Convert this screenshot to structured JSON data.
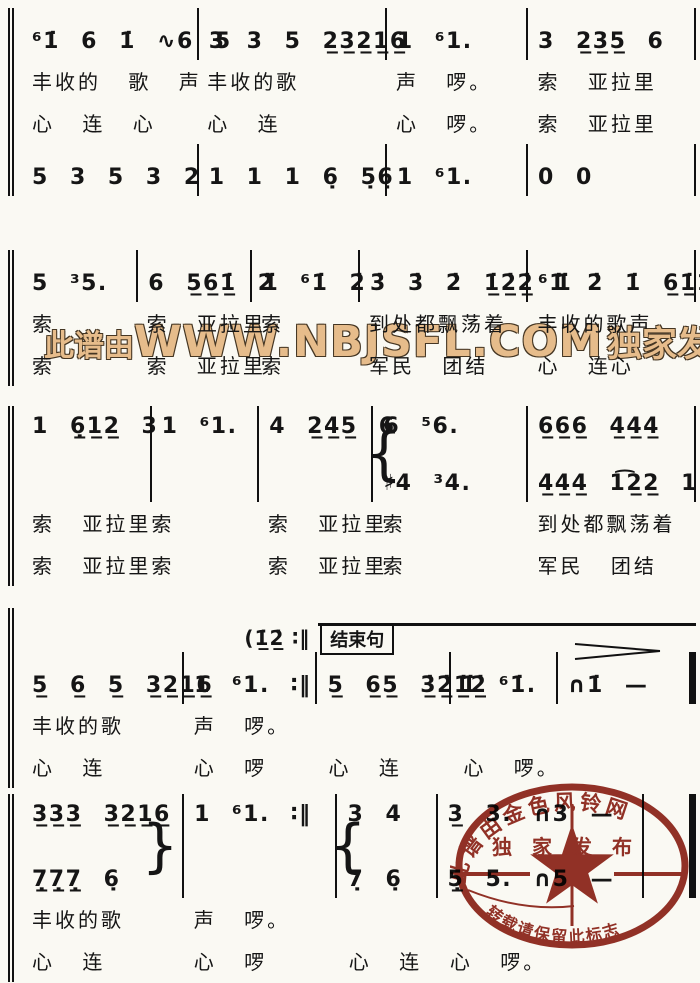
{
  "watermark": {
    "prefix": "此谱由",
    "domain": "WWW.NBJSFL.COM",
    "suffix": "独家发布",
    "color": "#e6bc8b"
  },
  "stamp": {
    "arc_text": "此谱由金色风铃网",
    "mid_text": "独家发布",
    "bottom_text": "转载请保留此标志",
    "color": "#8b2015"
  },
  "systems": [
    {
      "rows": [
        {
          "kind": "notes",
          "cells": [
            "⁶1̇ 6 1̇ ∿6 5",
            "3 3 5 2̲3̲2̲1̲6̲",
            "1 ⁶1.",
            "3 2̲3̲5̲ 6"
          ]
        },
        {
          "kind": "lyrics",
          "cells": [
            "丰收的 歌 声",
            "丰收的歌",
            "声 啰。",
            "索 亚拉里"
          ]
        },
        {
          "kind": "lyrics",
          "cells": [
            "心 连 心",
            "心 连",
            "心 啰。",
            "索 亚拉里"
          ]
        },
        {
          "kind": "notes",
          "cells": [
            "5 3 5 3 2",
            "1 1 1 6̣ 5̣6̣",
            "1 ⁶1.",
            "0 0"
          ]
        }
      ]
    },
    {
      "rows": [
        {
          "kind": "notes",
          "cells": [
            "5 ³5.",
            "6 5̲6̲1̲̇ 2̇",
            "1̇ ⁶1̇ 2̇",
            "3̇ 3̇ 2̇ 1̲̇2̲̇2̲̇ 1̇",
            "⁶1̇ 2̇ 1̇ 6̲1̲̇1̲̇ 6"
          ]
        },
        {
          "kind": "lyrics",
          "cells": [
            "索",
            "索 亚拉里",
            "索",
            "到处都飘荡着",
            "丰收的歌声"
          ]
        },
        {
          "kind": "lyrics",
          "cells": [
            "索",
            "索 亚拉里",
            "索",
            "军民 团结",
            "心 连心"
          ]
        }
      ]
    },
    {
      "rows": [
        {
          "kind": "notes",
          "cells": [
            "1 6̲̣1̲2̲ 3",
            "1 ⁶1.",
            "4 2̲4̲5̲ 6",
            {
              "top": "6 ⁵6.",
              "bottom": "♯4 ³4.",
              "brace": "left"
            },
            {
              "top": "6̲6̲6̲ 4̲4̲4̲",
              "bottom": "4̲4̲4̲ 1͡2̲2̲ 1"
            }
          ]
        },
        {
          "kind": "lyrics",
          "cells": [
            "索 亚拉里索",
            "",
            "索 亚拉里",
            "索",
            "到处都飘荡着"
          ]
        },
        {
          "kind": "lyrics",
          "cells": [
            "索 亚拉里索",
            "",
            "索 亚拉里",
            "索",
            "军民 团结"
          ]
        }
      ]
    },
    {
      "cue": {
        "pickup": "(1̲̇2̲̇ ∶‖",
        "label": "结束句"
      },
      "rows": [
        {
          "kind": "notes",
          "cells": [
            "5̲ 6̲ 5̲ 3̲2̲1̲6̲",
            "1 ⁶1. ∶‖",
            "5̲ 6̲5̲ 3̲̇2̲̇1̲̇2̲̇",
            "1̇ ⁶1̇.",
            "∩1̇ —"
          ]
        },
        {
          "kind": "lyrics",
          "cells": [
            "丰收的歌",
            "声 啰。",
            "",
            "",
            ""
          ]
        },
        {
          "kind": "lyrics",
          "cells": [
            "心 连",
            "心 啰",
            "心 连",
            "心 啰。",
            ""
          ]
        }
      ]
    },
    {
      "rows": [
        {
          "kind": "notes",
          "cells": [
            {
              "top": "3̲3̲3̲ 3̲2̲1̲6̲",
              "bottom": "7̲̣7̲̣7̲̣ 6̣",
              "brace": "right"
            },
            "1 ⁶1. ∶‖",
            {
              "top": "3 4",
              "bottom": "7̣ 6̣",
              "brace": "left"
            },
            {
              "top": "3̲ 3. ∩3 —",
              "bottom": "5̲̣ 5. ∩5 —"
            },
            ""
          ]
        },
        {
          "kind": "lyrics",
          "cells": [
            "丰收的歌",
            "声 啰。",
            "",
            "",
            ""
          ]
        },
        {
          "kind": "lyrics",
          "cells": [
            "心 连",
            "心 啰",
            "心 连",
            "心 啰。",
            ""
          ]
        }
      ]
    }
  ]
}
